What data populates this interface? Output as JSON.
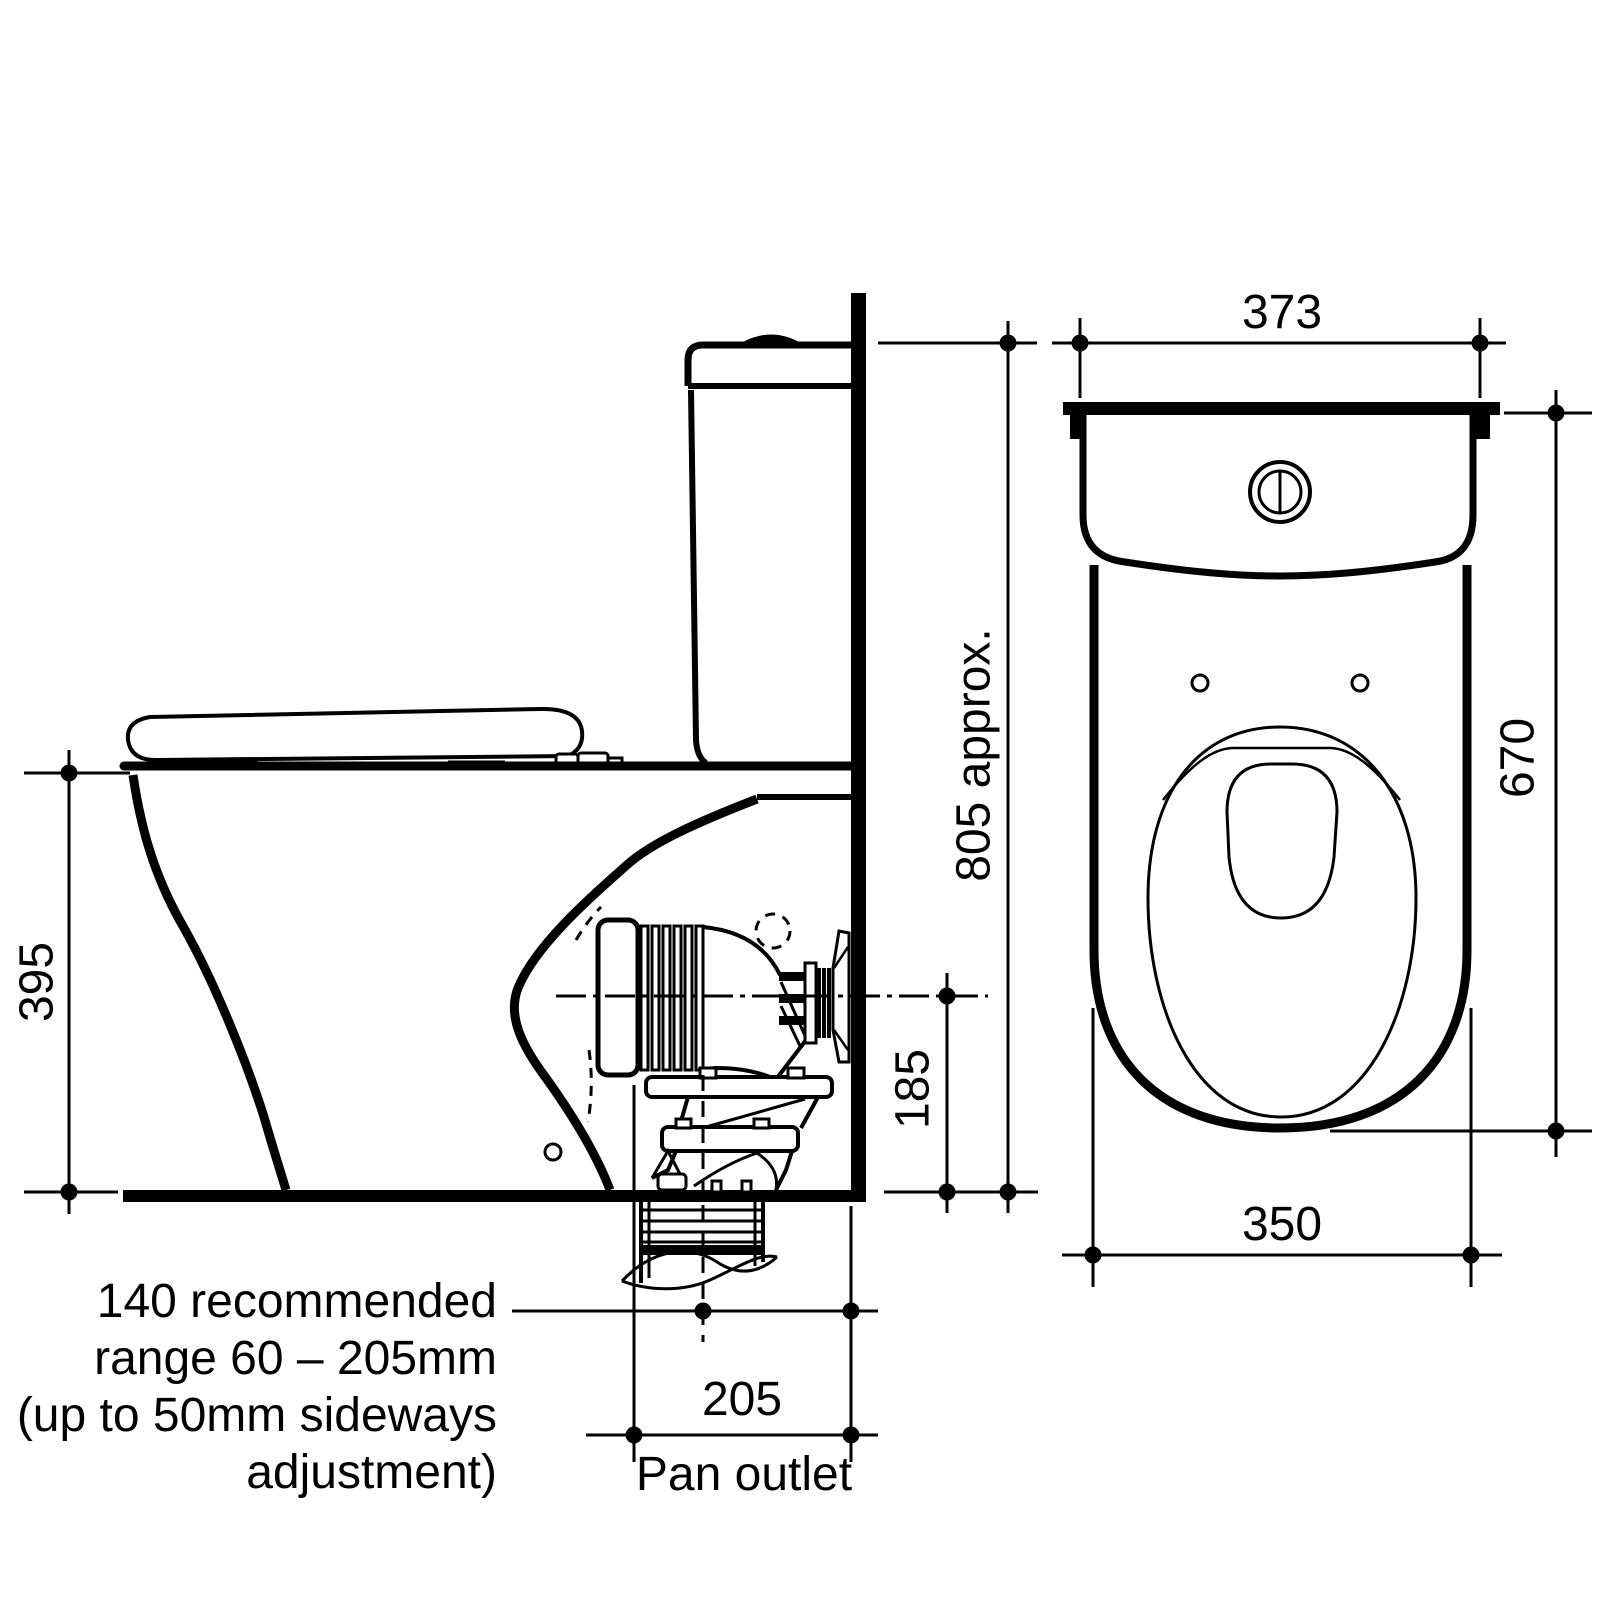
{
  "drawing": {
    "type": "technical-dimension-drawing",
    "subject": "back-to-wall toilet suite installation dimensions",
    "background_color": "#ffffff",
    "line_color": "#000000",
    "side_view": {
      "dim_rim_height": "395",
      "dim_overall_height": "805 approx.",
      "dim_outlet_centre_height": "185",
      "dim_outlet_setout": "205",
      "outlet_label": "Pan outlet",
      "note_lines": [
        "140 recommended",
        "range 60 – 205mm",
        "(up to 50mm sideways",
        "adjustment)"
      ]
    },
    "front_view": {
      "dim_width_top": "373",
      "dim_depth": "670",
      "dim_width_base": "350"
    }
  }
}
